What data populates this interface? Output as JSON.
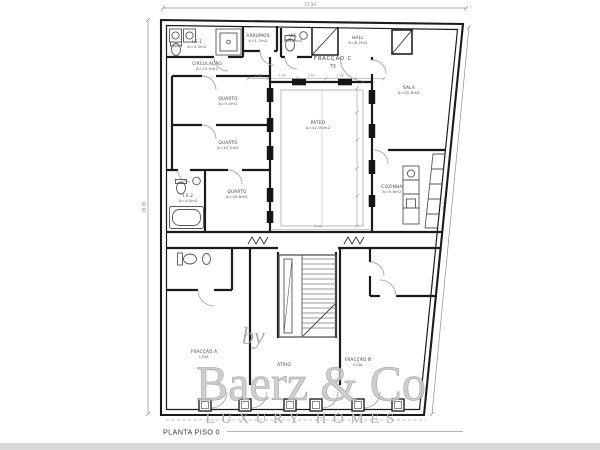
{
  "page": {
    "background": "#ffffff",
    "bottom_bar_color": "#d9d9d9"
  },
  "title_block": {
    "label": "PLANTA PISO 0"
  },
  "watermark": {
    "by": "by",
    "brand": "Baerz & Co",
    "tagline": "LUXURY HOMES"
  },
  "dimensions": {
    "top": {
      "label": "17.36"
    },
    "left": {
      "label": "18.81"
    },
    "right": {
      "label": "20.06"
    },
    "chain_top": [
      {
        "label": "1.06",
        "x": 258
      },
      {
        "label": "1.80",
        "x": 282
      },
      {
        "label": "1.90",
        "x": 311
      },
      {
        "label": "1.90",
        "x": 340
      }
    ],
    "extra": [
      {
        "label": "4.80",
        "x": 318,
        "y": 227.5
      }
    ]
  },
  "plan": {
    "unit_title": {
      "name": "FRACÇÃO C",
      "type": "T3"
    },
    "rooms": [
      {
        "name": "I.S.1",
        "area": "A=4.3m2",
        "x": 197,
        "y": 43
      },
      {
        "name": "ARRUMOS",
        "area": "A=1.7m2",
        "x": 258,
        "y": 37
      },
      {
        "name": "WC",
        "area": "A=1.9m2",
        "x": 293,
        "y": 37
      },
      {
        "name": "HALL",
        "area": "A=8.2m2",
        "x": 358,
        "y": 39
      },
      {
        "name": "CIRCULAÇÃO",
        "area": "A=13.9m2",
        "x": 207,
        "y": 65
      },
      {
        "name": "QUARTO",
        "area": "A=9.0m2",
        "x": 228,
        "y": 100
      },
      {
        "name": "QUARTO",
        "area": "A=10.2m2",
        "x": 228,
        "y": 144
      },
      {
        "name": "QUARTO",
        "area": "A=10.8m2",
        "x": 237,
        "y": 193
      },
      {
        "name": "I.S.2",
        "area": "A=4.0m2",
        "x": 188,
        "y": 197
      },
      {
        "name": "PÁTEO",
        "area": "A=42.00m2",
        "x": 318,
        "y": 124
      },
      {
        "name": "SALA",
        "area": "A=32.8m2",
        "x": 409,
        "y": 89
      },
      {
        "name": "COZINHA",
        "area": "A=9.8m2",
        "x": 392,
        "y": 188
      },
      {
        "name": "FRACÇÃO A",
        "area": "LOJA",
        "x": 204,
        "y": 353
      },
      {
        "name": "ÁTRIO",
        "area": "",
        "x": 284,
        "y": 366
      },
      {
        "name": "FRACÇÃO B",
        "area": "LOJA",
        "x": 358,
        "y": 361
      }
    ]
  }
}
